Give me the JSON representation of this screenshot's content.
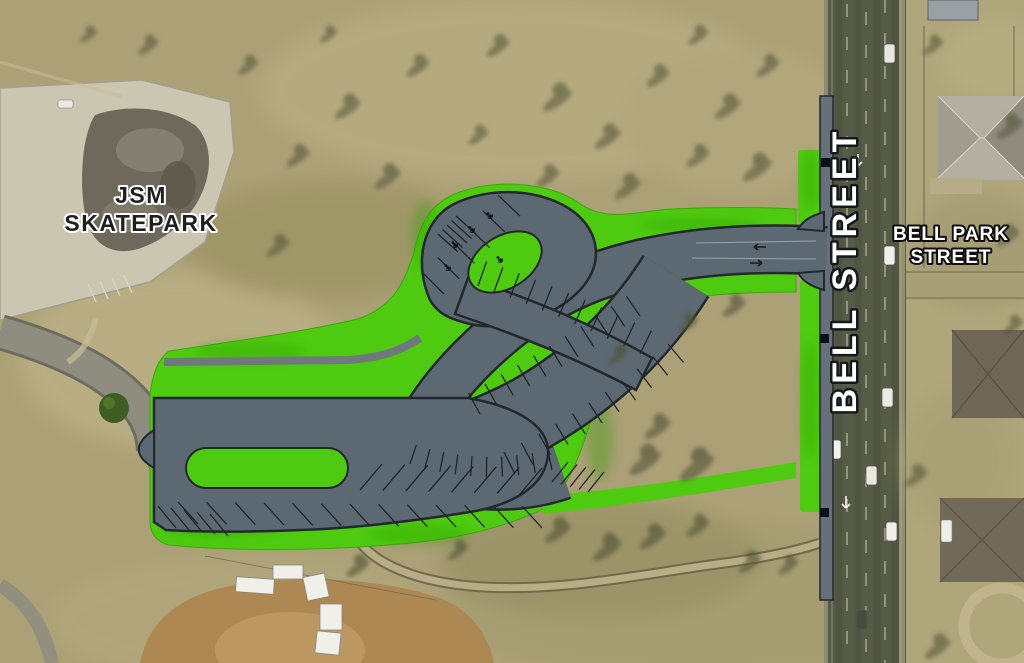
{
  "map": {
    "labels": {
      "skatepark": {
        "line1": "JSM",
        "line2": "SKATEPARK"
      },
      "bell_street": "BELL STREET",
      "bell_park": {
        "line1": "BELL PARK",
        "line2": "STREET"
      }
    },
    "colors": {
      "landscape_green": "#4ecb10",
      "pavement": "#5d6972",
      "plan_outline": "#23282e",
      "field": "#aca077",
      "street": "#565b45",
      "trail": "#b9ad85",
      "ballfield_dirt": "#ad8852",
      "sidewalk": "#67707a"
    },
    "icons": {
      "accessible_parking_icon": "wheelchair",
      "turn_arrow_icon": "turn-arrow"
    }
  }
}
